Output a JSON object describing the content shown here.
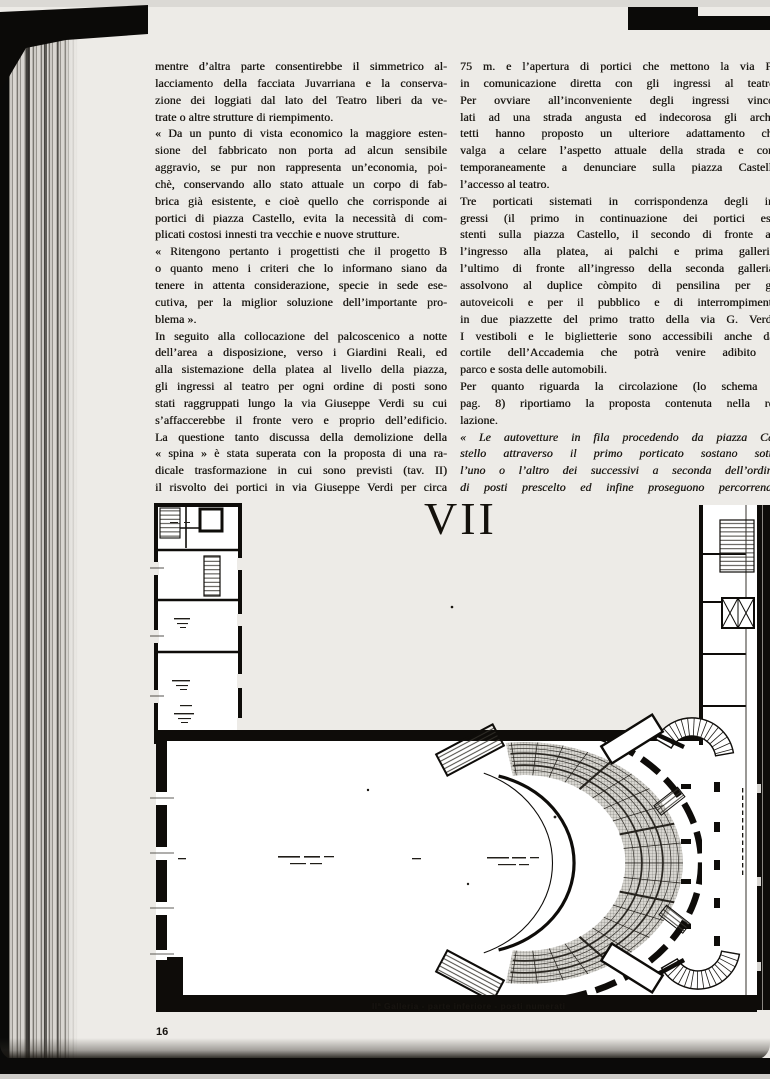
{
  "page": {
    "number": "16"
  },
  "colors": {
    "page_bg": "#edebe7",
    "ink": "#1c1914",
    "plan_ink": "#0e0c09",
    "seating_fill": "#d8d6d1"
  },
  "plate": {
    "number": "VII",
    "caption": "IIª Galleria - parte inferiore - posti numerati"
  },
  "article": {
    "left_column": [
      {
        "flush_last": true,
        "lines": [
          "mentre d’altra parte consentirebbe il simmetrico al-",
          "lacciamento della facciata Juvarriana e la conserva-",
          "zione dei loggiati dal lato del Teatro liberi da ve-",
          "trate o altre strutture di riempimento."
        ]
      },
      {
        "flush_last": true,
        "lines": [
          "« Da un punto di vista economico la maggiore esten-",
          "sione del fabbricato non porta ad alcun sensibile",
          "aggravio, se pur non rappresenta un’economia, poi-",
          "chè, conservando allo stato attuale un corpo di fab-",
          "brica già esistente, e cioè quello che corrisponde ai",
          "portici di piazza Castello, evita la necessità di com-",
          "plicati costosi innesti tra vecchie e nuove strutture."
        ]
      },
      {
        "flush_last": true,
        "lines": [
          "« Ritengono pertanto i progettisti che il progetto B",
          "o quanto meno i criteri che lo informano siano da",
          "tenere in attenta considerazione, specie in sede ese-",
          "cutiva, per la miglior soluzione dell’importante pro-",
          "blema »."
        ]
      },
      {
        "flush_last": false,
        "lines": [
          "In seguito alla collocazione del palcoscenico a notte",
          "dell’area a disposizione, verso i Giardini Reali, ed",
          "alla sistemazione della platea al livello della piazza,",
          "gli ingressi al teatro per ogni ordine di posti sono",
          "stati raggruppati lungo la via Giuseppe Verdi su cui",
          "s’affaccerebbe il fronte vero e proprio dell’edificio.",
          "La questione tanto discussa della demolizione della",
          "« spina » è stata superata con la proposta di una ra-",
          "dicale trasformazione in cui sono previsti (tav. II)",
          "il risvolto dei portici in via Giuseppe Verdi per circa"
        ]
      }
    ],
    "right_column": [
      {
        "flush_last": true,
        "lines": [
          "75 m. e l’apertura di portici che mettono la via Po",
          "in comunicazione diretta con gli ingressi al teatro.",
          "Per ovviare all’inconveniente degli ingressi vinco-",
          "lati ad una strada angusta ed indecorosa gli archi-",
          "tetti hanno proposto un ulteriore adattamento che",
          "valga a celare l’aspetto attuale della strada e con-",
          "temporaneamente a denunciare sulla piazza Castello",
          "l’accesso al teatro."
        ]
      },
      {
        "flush_last": true,
        "lines": [
          "Tre porticati sistemati in corrispondenza degli in-",
          "gressi (il primo in continuazione dei portici esi-",
          "stenti sulla piazza Castello, il secondo di fronte al-",
          "l’ingresso alla platea, ai palchi e prima galleria,",
          "l’ultimo di fronte all’ingresso della seconda galleria)",
          "assolvono al duplice còmpito di pensilina per gli",
          "autoveicoli e per il pubblico e di interrompimento",
          "in due piazzette del primo tratto della via G. Verdi.",
          "I vestiboli e le biglietterie sono accessibili anche dal",
          "cortile dell’Accademia che potrà venire adibito a",
          "parco e sosta delle automobili."
        ]
      },
      {
        "flush_last": true,
        "lines": [
          "Per quanto riguarda la circolazione (lo schema a",
          "pag. 8) riportiamo la proposta contenuta nella re-",
          "lazione."
        ]
      },
      {
        "italic": true,
        "flush_last": false,
        "lines": [
          "« Le autovetture in fila procedendo da piazza Ca-",
          "stello attraverso il primo porticato sostano sotto",
          "l’uno o l’altro dei successivi a seconda dell’ordine",
          "di posti prescelto ed infine proseguono percorrendo"
        ]
      }
    ]
  }
}
